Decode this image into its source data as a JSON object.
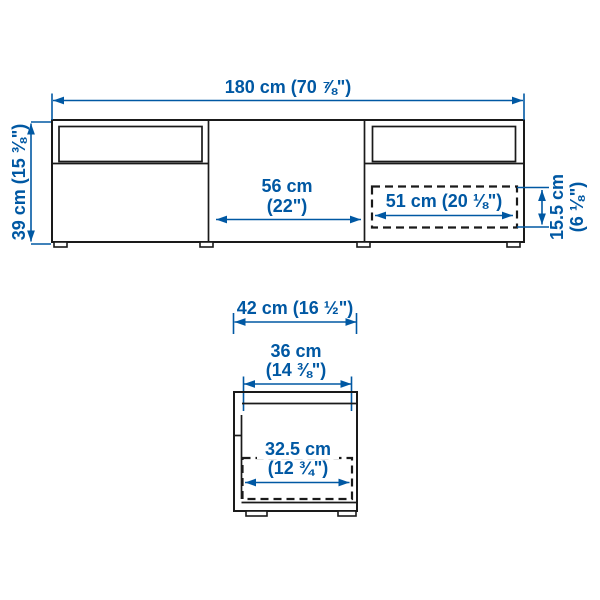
{
  "diagram_type": "furniture-dimension-diagram",
  "colors": {
    "dimension_blue": "#0058a3",
    "outline_black": "#1a1a1a",
    "background": "#ffffff"
  },
  "front_view": {
    "overall_width_label": "180 cm (70 ⅞\")",
    "overall_height_label": "39 cm (15 ⅜\")",
    "center_opening_width_line1": "56 cm",
    "center_opening_width_line2": "(22\")",
    "drawer_inner_width_label": "51 cm (20 ⅛\")",
    "drawer_inner_height_line1": "15.5 cm",
    "drawer_inner_height_line2": "(6 ⅛\")"
  },
  "side_view": {
    "overall_depth_label": "42 cm (16 ½\")",
    "top_inner_depth_line1": "36 cm",
    "top_inner_depth_line2": "(14 ⅜\")",
    "drawer_inner_depth_line1": "32.5 cm",
    "drawer_inner_depth_line2": "(12 ¾\")"
  }
}
